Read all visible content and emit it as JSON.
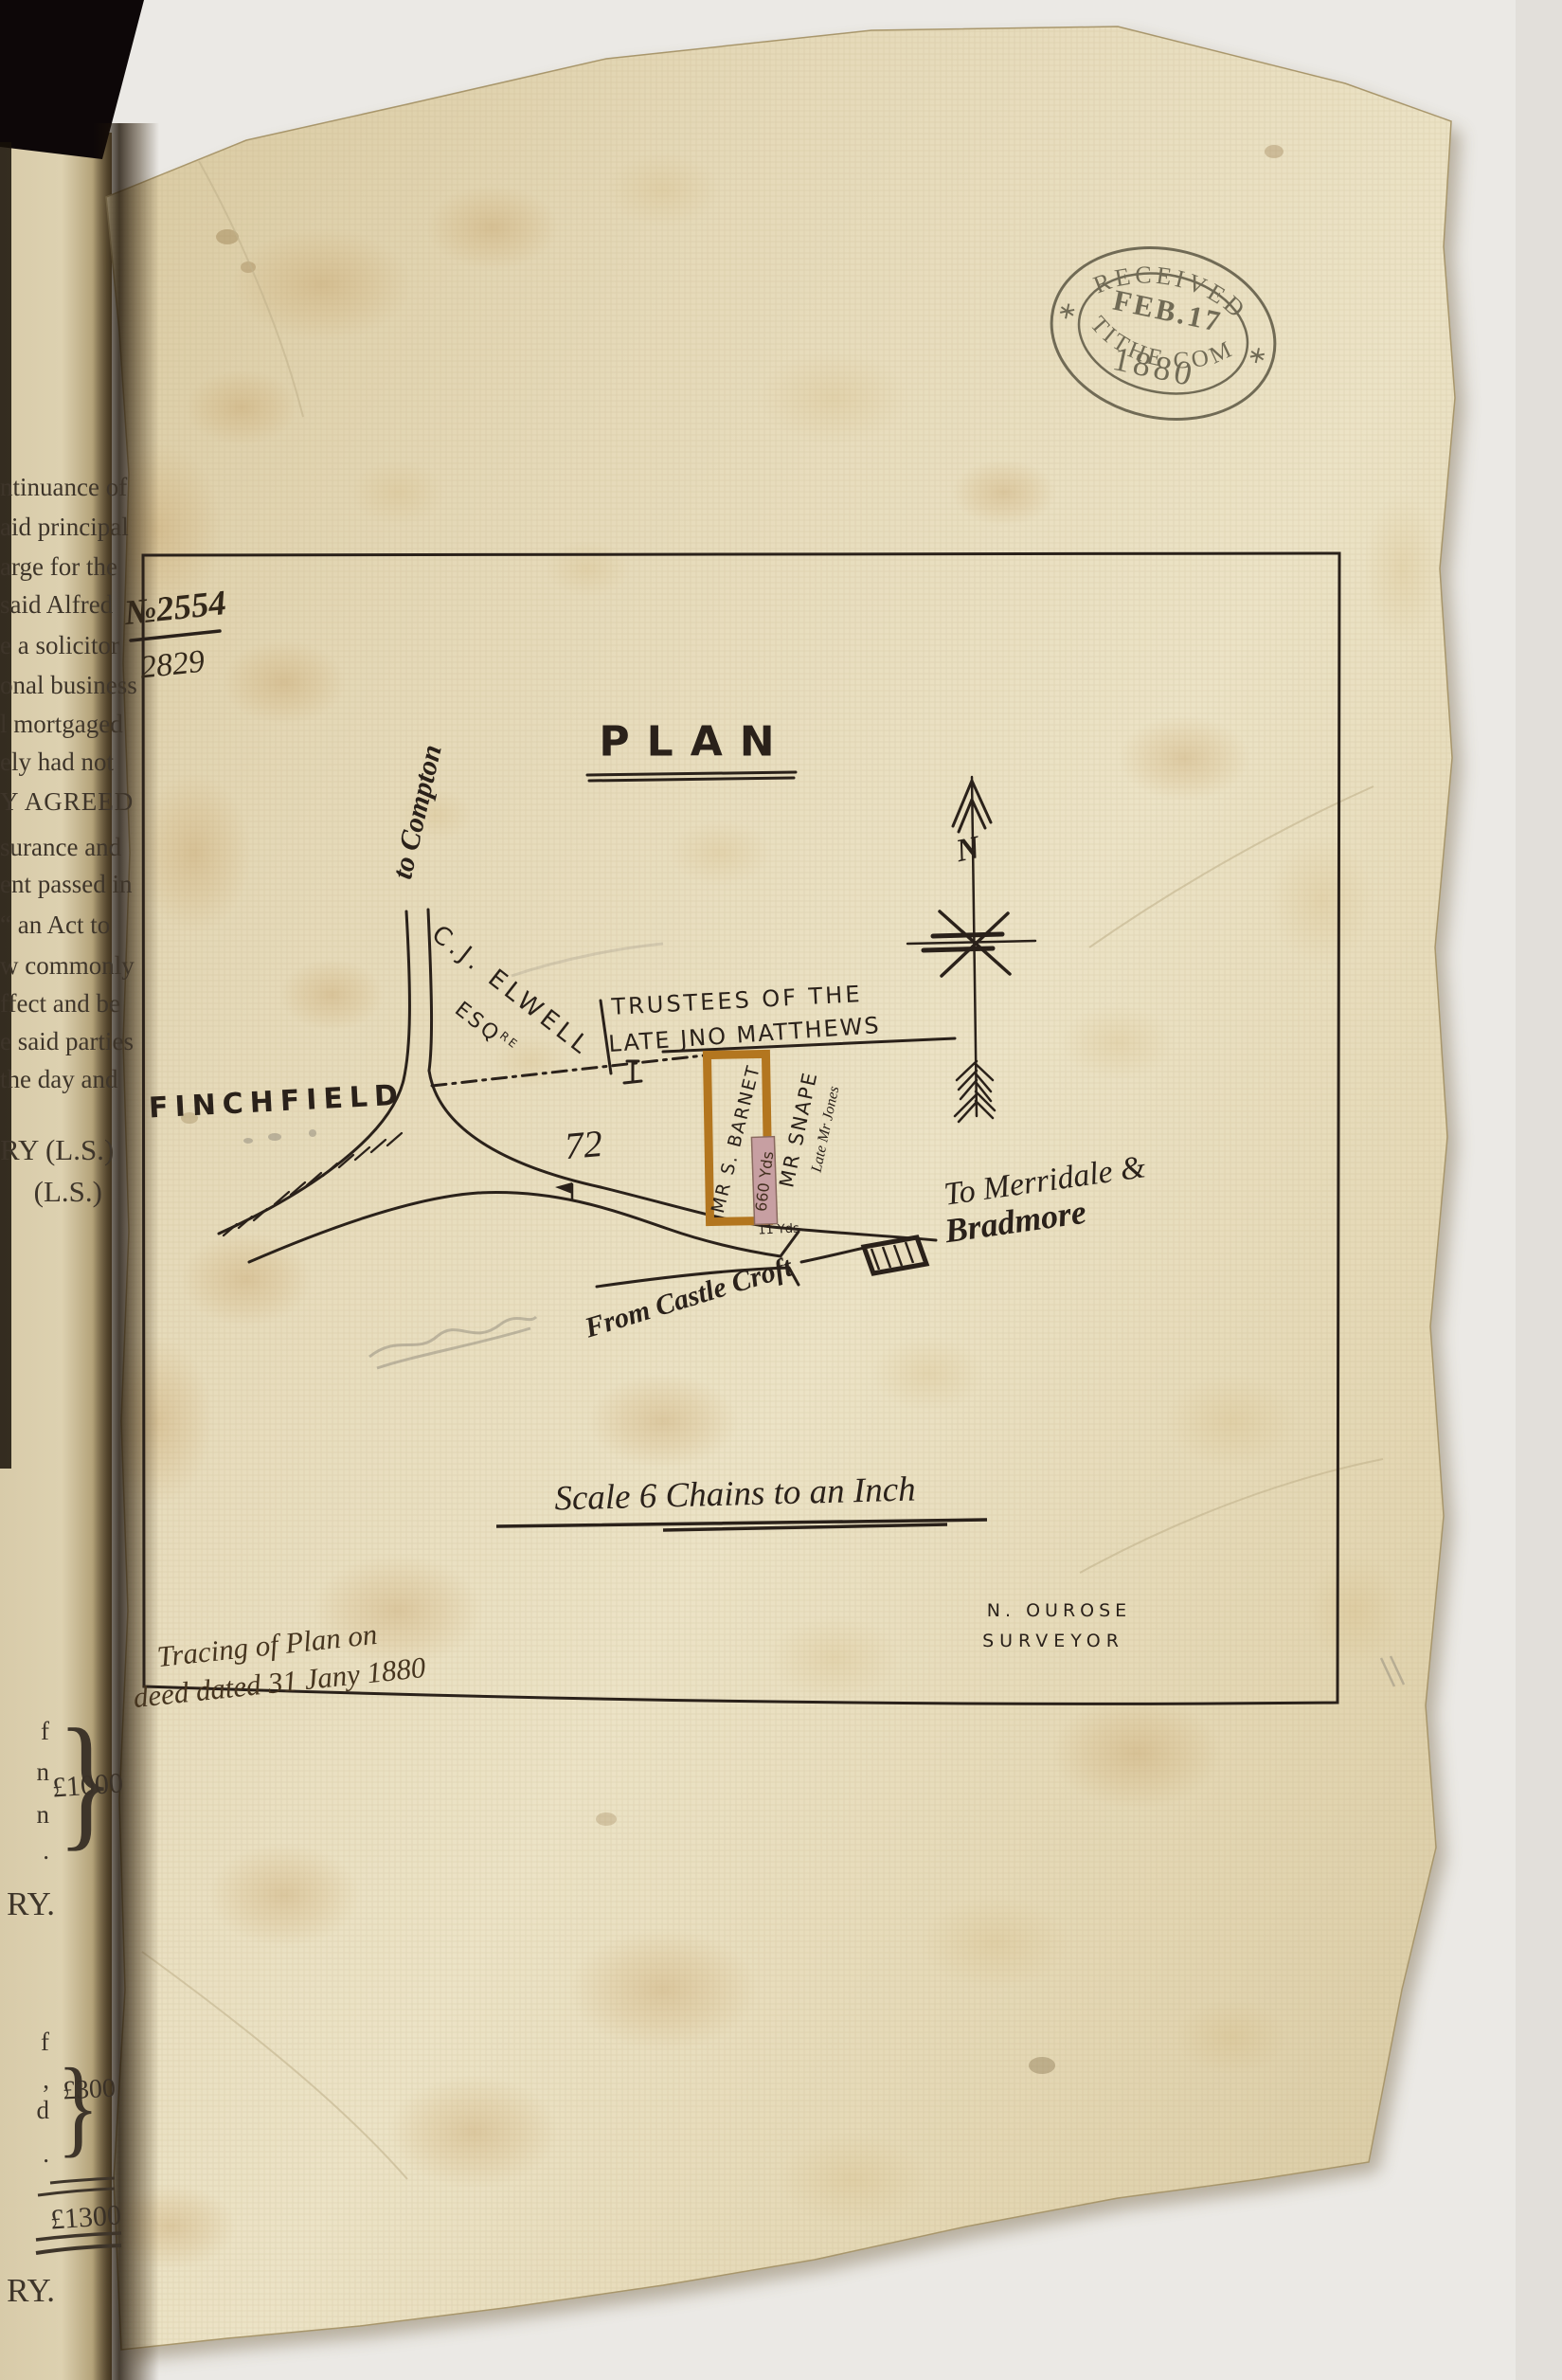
{
  "page": {
    "background": "#ebe9e5",
    "vellum_color": "#e2d5b1",
    "ink_color": "#2a211a",
    "stamp_ink": "#57523f",
    "parcel_outline_color": "#b3761f",
    "strip_fill_color": "#c79fa2"
  },
  "stamp": {
    "top": "RECEIVED",
    "date": "FEB.17",
    "year": "1880",
    "bottom": "TITHE COM"
  },
  "refs": {
    "numerator": "№2554",
    "denominator": "2829"
  },
  "plan": {
    "title": "PLAN",
    "compass_letter": "N",
    "labels": {
      "to_compton": "to Compton",
      "elwell_name": "C.J. ELWELL",
      "elwell_esq": "ESQ",
      "elwell_esq_sup": "RE",
      "trustees_line1": "TRUSTEES OF THE",
      "trustees_line2": "LATE JNO MATTHEWS",
      "finchfield": "FINCHFIELD",
      "parcel_number": "72",
      "barnet": "MR S. BARNET",
      "area": "660 Yds",
      "snape": "MR SNAPE",
      "late_jones": "Late Mr Jones",
      "frontage": "11 Yds",
      "merridale_line1": "To Merridale &",
      "merridale_line2": "Bradmore",
      "castle_croft": "From Castle Croft"
    },
    "scale_note": "Scale 6 Chains to an Inch",
    "surveyor_name": "N. OUROSE",
    "surveyor_title": "SURVEYOR",
    "tracing_line1": "Tracing of Plan on",
    "tracing_line2": "deed dated 31 Jany 1880"
  },
  "left_page": {
    "fragments": [
      "ntinuance of",
      "aid principal",
      "arge for the",
      "said Alfred",
      "e a solicitor",
      "onal business",
      "l mortgaged",
      "ely had not",
      "Y AGREED",
      "surance and",
      "ent passed in",
      "“ an Act to",
      "w commonly",
      "ffect and be",
      "e said parties",
      "the day and"
    ],
    "sig1": "RY (L.S.)",
    "sig2": "(L.S.)",
    "brace": "}",
    "block1_fragments": [
      "f",
      "n",
      "n",
      "."
    ],
    "sum1": "£1000",
    "sig3": "RY.",
    "block2_fragments": [
      "f",
      ",",
      "d",
      "."
    ],
    "sum2": "£300",
    "total": "£1300",
    "sig4": "RY."
  }
}
